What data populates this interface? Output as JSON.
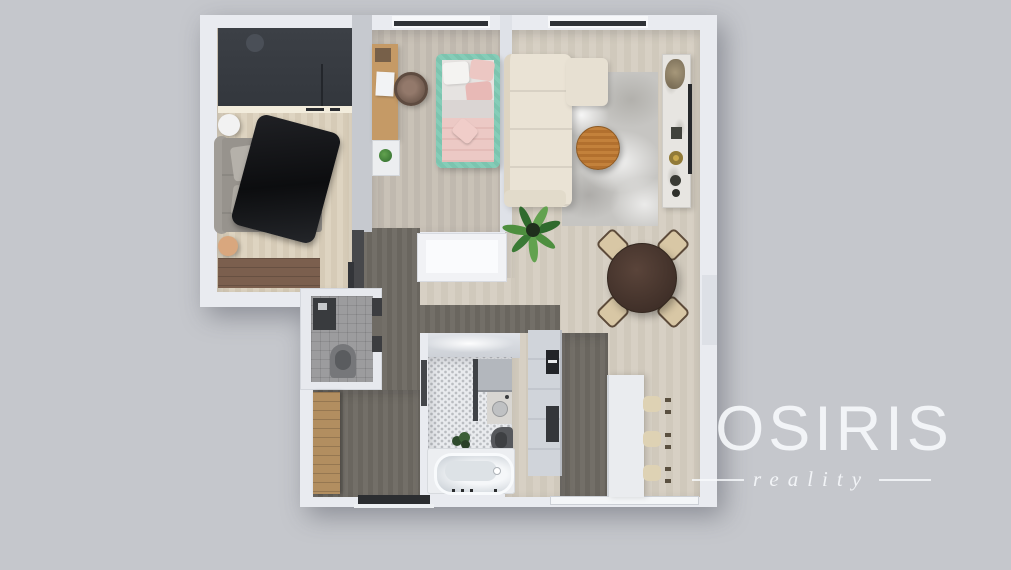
{
  "watermark": {
    "brand": "OSIRIS",
    "tagline": "reality"
  },
  "palette": {
    "background": "#c5c7cc",
    "wall": "#e9ebf0",
    "floor_light_wood": "#ddd3c0",
    "floor_gray_wood": "#c7c0b5",
    "floor_living_wood": "#d6cfc3",
    "floor_dark_taupe": "#6f6b64",
    "wardrobe_dark": "#373b41",
    "bed_blanket_black": "#17181a",
    "kids_bed_mint": "#82cbb6",
    "kids_bedding_pink": "#eac2bf",
    "desk_oak": "#c59a66",
    "sofa_cream": "#eae3d5",
    "coffee_table_wood": "#be7b36",
    "dining_table_brown": "#4a372f",
    "chair_beige": "#d8c7a5",
    "plant_green": "#4e8f3f",
    "logo_white": "#f8fafd"
  },
  "floorplan": {
    "view": "top-down-3d-render",
    "rooms": [
      {
        "name": "bedroom",
        "furniture": [
          "wardrobe",
          "double-bed",
          "black-fur-blanket",
          "round-nightstand",
          "round-stool",
          "dresser-bench"
        ]
      },
      {
        "name": "kids-room",
        "furniture": [
          "desk",
          "laptop",
          "rattan-chair",
          "shelf",
          "potted-plant",
          "single-bed-mint-pink"
        ]
      },
      {
        "name": "living-room",
        "furniture": [
          "corner-sofa",
          "area-rug",
          "round-coffee-table",
          "console-sideboard",
          "wall-tv",
          "potted-plant"
        ]
      },
      {
        "name": "dining-area",
        "furniture": [
          "round-table",
          "chair",
          "chair",
          "chair",
          "chair"
        ]
      },
      {
        "name": "kitchen",
        "furniture": [
          "tall-cabinet-column",
          "built-in-oven",
          "built-in-oven",
          "island-counter",
          "bar-stool",
          "bar-stool",
          "bar-stool"
        ]
      },
      {
        "name": "bathroom",
        "furniture": [
          "lit-counter",
          "storage-cabinet",
          "vanity-sink",
          "toilet",
          "plant",
          "bathtub"
        ]
      },
      {
        "name": "wc",
        "furniture": [
          "washing-machine",
          "toilet"
        ]
      },
      {
        "name": "hallway",
        "furniture": [
          "wooden-wardrobe",
          "entry-door"
        ]
      }
    ]
  }
}
